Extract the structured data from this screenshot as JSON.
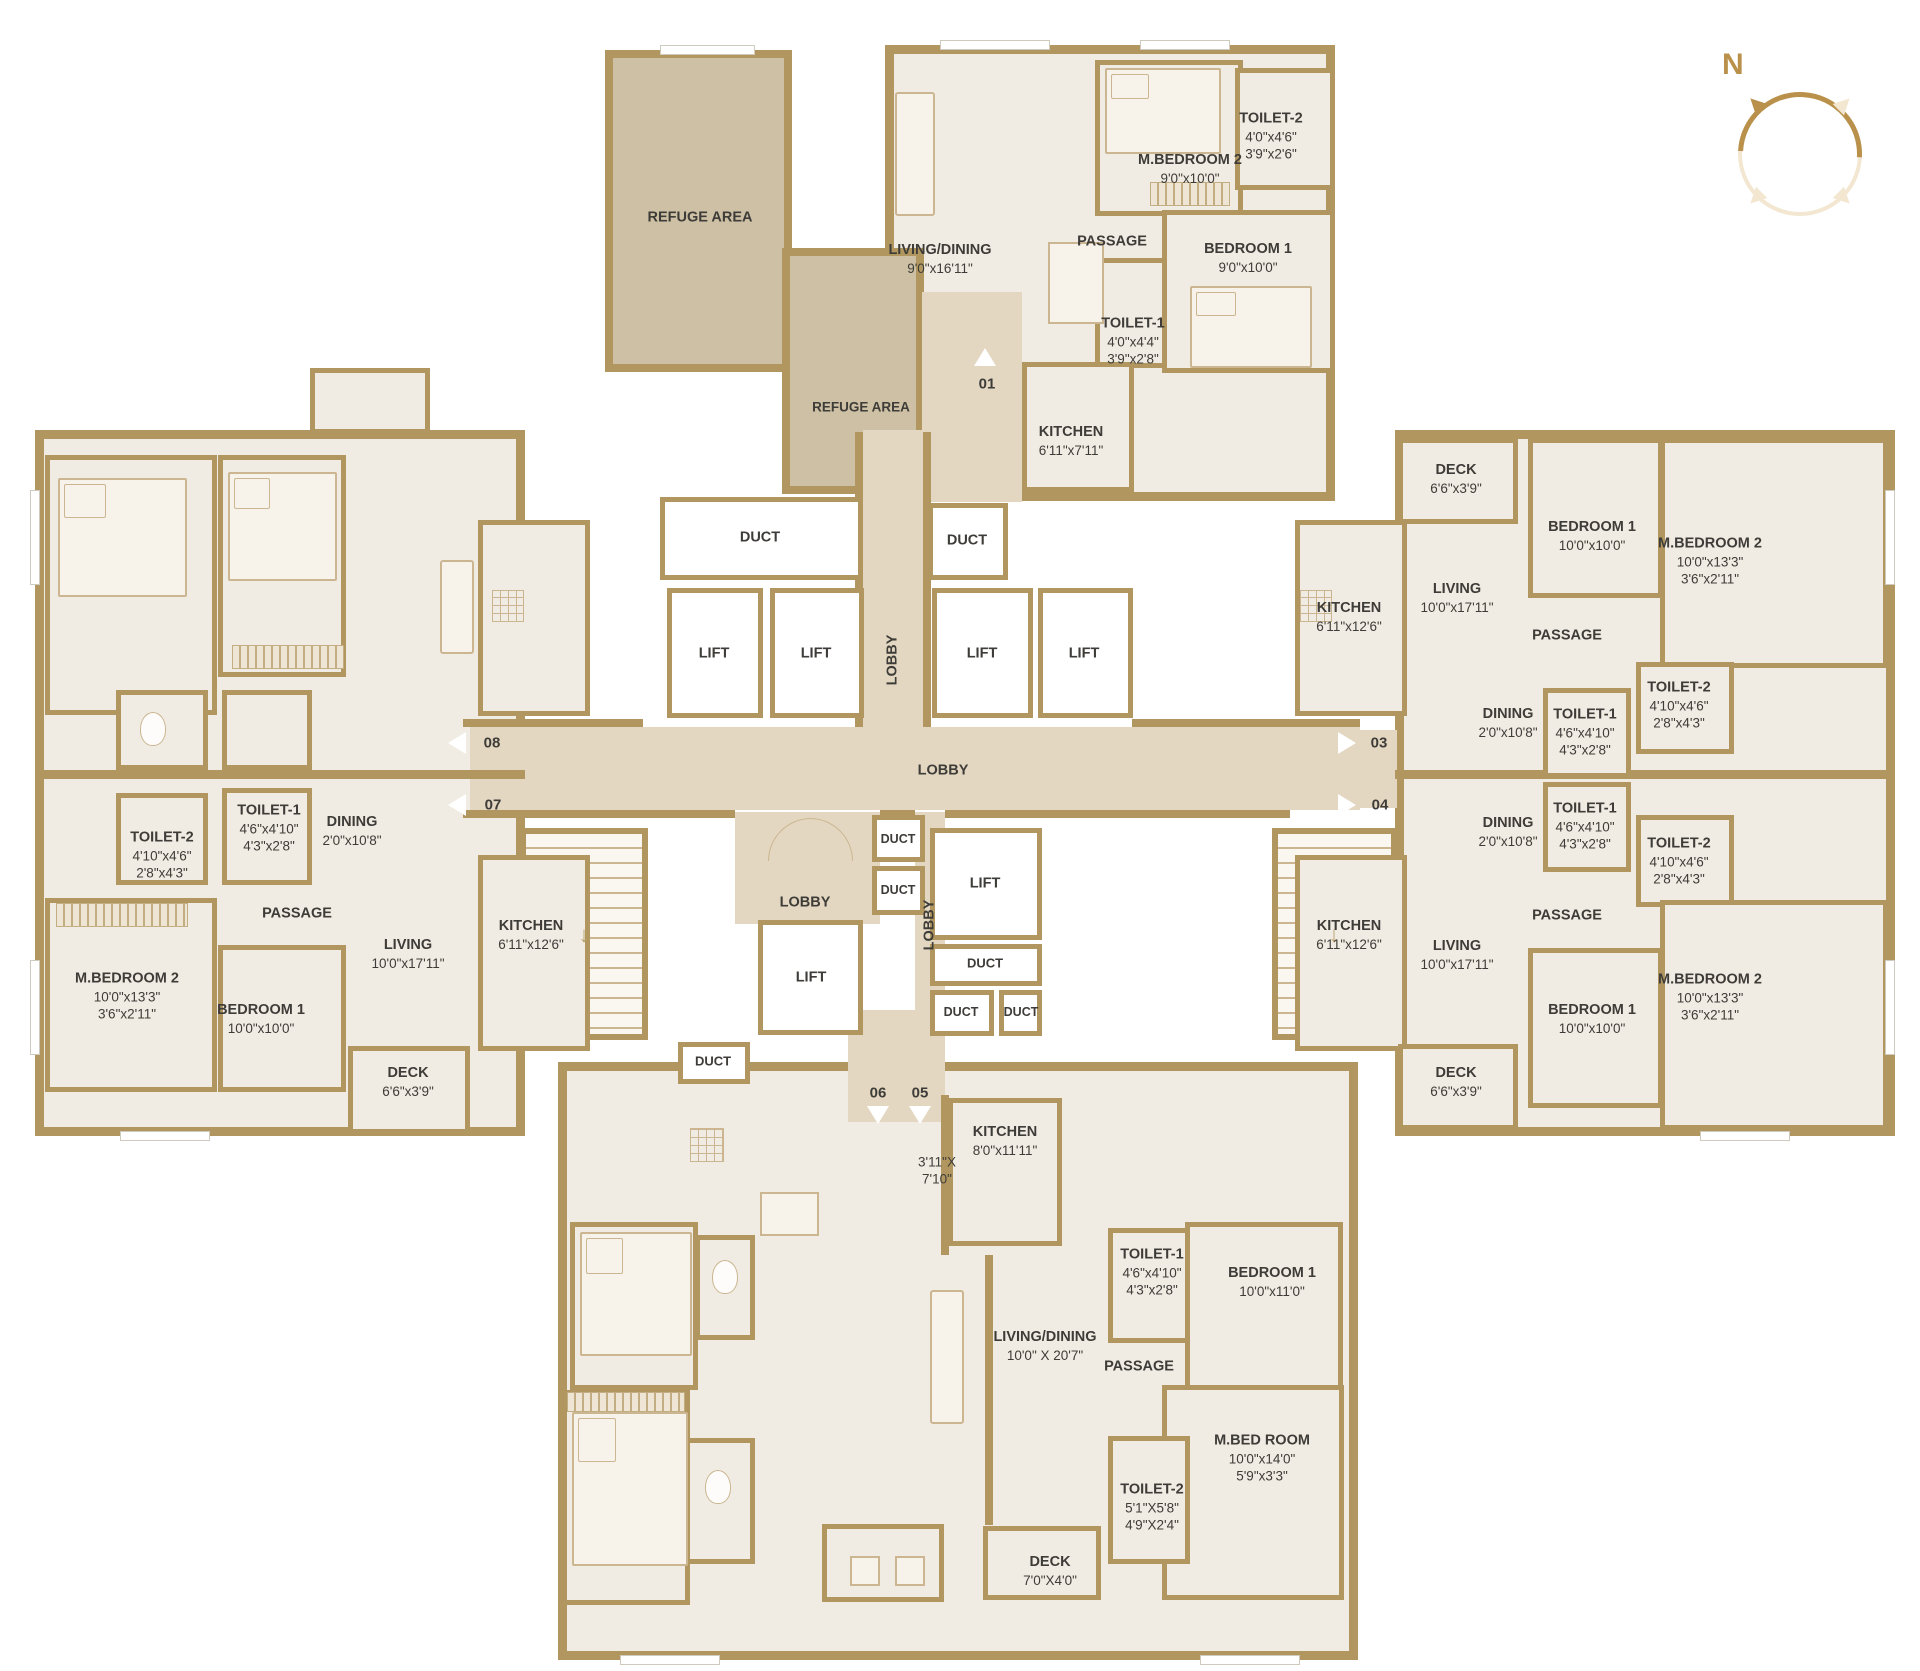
{
  "colors": {
    "wall": "#b1975f",
    "room_fill": "#f1ece3",
    "corridor_fill": "#e3d7c1",
    "refuge_fill": "#cdc0a4",
    "duct_fill": "#ffffff",
    "compass_accent": "#b9914b",
    "text": "#3e3c38"
  },
  "compass": {
    "north_label": "N"
  },
  "refuge": {
    "area1_label": "REFUGE AREA",
    "area2_label": "REFUGE AREA"
  },
  "core": {
    "lobby_top": "LOBBY",
    "lobby_main": "LOBBY",
    "lobby_small": "LOBBY",
    "lobby_bottom": "LOBBY",
    "lift1": "LIFT",
    "lift2": "LIFT",
    "lift3": "LIFT",
    "lift4": "LIFT",
    "lift5": "LIFT",
    "lift6": "LIFT",
    "duct1": "DUCT",
    "duct2": "DUCT",
    "duct3": "DUCT",
    "duct4": "DUCT",
    "duct5": "DUCT",
    "duct6": "DUCT",
    "duct7": "DUCT",
    "duct8": "DUCT"
  },
  "entrances": {
    "e01": "01",
    "e03": "03",
    "e04": "04",
    "e05": "05",
    "e06": "06",
    "e07": "07",
    "e08": "08"
  },
  "units": {
    "u01": {
      "mbedroom2": {
        "name": "M.BEDROOM 2",
        "dim": "9'0\"x10'0\""
      },
      "toilet2": {
        "name": "TOILET-2",
        "dim": "4'0\"x4'6\"",
        "dim2": "3'9\"x2'6\""
      },
      "livingdining": {
        "name": "LIVING/DINING",
        "dim": "9'0\"x16'11\""
      },
      "passage": {
        "name": "PASSAGE"
      },
      "bedroom1": {
        "name": "BEDROOM 1",
        "dim": "9'0\"x10'0\""
      },
      "toilet1": {
        "name": "TOILET-1",
        "dim": "4'0\"x4'4\"",
        "dim2": "3'9\"x2'8\""
      },
      "kitchen": {
        "name": "KITCHEN",
        "dim": "6'11\"x7'11\""
      }
    },
    "u03": {
      "deck": {
        "name": "DECK",
        "dim": "6'6\"x3'9\""
      },
      "kitchen": {
        "name": "KITCHEN",
        "dim": "6'11\"x12'6\""
      },
      "living": {
        "name": "LIVING",
        "dim": "10'0\"x17'11\""
      },
      "bedroom1": {
        "name": "BEDROOM 1",
        "dim": "10'0\"x10'0\""
      },
      "mbedroom2": {
        "name": "M.BEDROOM 2",
        "dim": "10'0\"x13'3\"",
        "dim2": "3'6\"x2'11\""
      },
      "passage": {
        "name": "PASSAGE"
      },
      "dining": {
        "name": "DINING",
        "dim": "2'0\"x10'8\""
      },
      "toilet1": {
        "name": "TOILET-1",
        "dim": "4'6\"x4'10\"",
        "dim2": "4'3\"x2'8\""
      },
      "toilet2": {
        "name": "TOILET-2",
        "dim": "4'10\"x4'6\"",
        "dim2": "2'8\"x4'3\""
      }
    },
    "u04": {
      "deck": {
        "name": "DECK",
        "dim": "6'6\"x3'9\""
      },
      "kitchen": {
        "name": "KITCHEN",
        "dim": "6'11\"x12'6\""
      },
      "living": {
        "name": "LIVING",
        "dim": "10'0\"x17'11\""
      },
      "bedroom1": {
        "name": "BEDROOM 1",
        "dim": "10'0\"x10'0\""
      },
      "mbedroom2": {
        "name": "M.BEDROOM 2",
        "dim": "10'0\"x13'3\"",
        "dim2": "3'6\"x2'11\""
      },
      "passage": {
        "name": "PASSAGE"
      },
      "dining": {
        "name": "DINING",
        "dim": "2'0\"x10'8\""
      },
      "toilet1": {
        "name": "TOILET-1",
        "dim": "4'6\"x4'10\"",
        "dim2": "4'3\"x2'8\""
      },
      "toilet2": {
        "name": "TOILET-2",
        "dim": "4'10\"x4'6\"",
        "dim2": "2'8\"x4'3\""
      }
    },
    "u07": {
      "deck": {
        "name": "DECK",
        "dim": "6'6\"x3'9\""
      },
      "kitchen": {
        "name": "KITCHEN",
        "dim": "6'11\"x12'6\""
      },
      "living": {
        "name": "LIVING",
        "dim": "10'0\"x17'11\""
      },
      "bedroom1": {
        "name": "BEDROOM 1",
        "dim": "10'0\"x10'0\""
      },
      "mbedroom2": {
        "name": "M.BEDROOM 2",
        "dim": "10'0\"x13'3\"",
        "dim2": "3'6\"x2'11\""
      },
      "passage": {
        "name": "PASSAGE"
      },
      "dining": {
        "name": "DINING",
        "dim": "2'0\"x10'8\""
      },
      "toilet1": {
        "name": "TOILET-1",
        "dim": "4'6\"x4'10\"",
        "dim2": "4'3\"x2'8\""
      },
      "toilet2": {
        "name": "TOILET-2",
        "dim": "4'10\"x4'6\"",
        "dim2": "2'8\"x4'3\""
      }
    },
    "u05": {
      "kitchen": {
        "name": "KITCHEN",
        "dim": "8'0\"x11'11\""
      },
      "hall": {
        "dim": "3'11\"X",
        "dim2": "7'10\""
      },
      "toilet1": {
        "name": "TOILET-1",
        "dim": "4'6\"x4'10\"",
        "dim2": "4'3\"x2'8\""
      },
      "livingdining": {
        "name": "LIVING/DINING",
        "dim": "10'0\" X 20'7\""
      },
      "passage": {
        "name": "PASSAGE"
      },
      "bedroom1": {
        "name": "BEDROOM 1",
        "dim": "10'0\"x11'0\""
      },
      "mbedroom": {
        "name": "M.BED ROOM",
        "dim": "10'0\"x14'0\"",
        "dim2": "5'9\"x3'3\""
      },
      "toilet2": {
        "name": "TOILET-2",
        "dim": "5'1\"X5'8\"",
        "dim2": "4'9\"X2'4\""
      },
      "deck": {
        "name": "DECK",
        "dim": "7'0\"X4'0\""
      }
    }
  }
}
